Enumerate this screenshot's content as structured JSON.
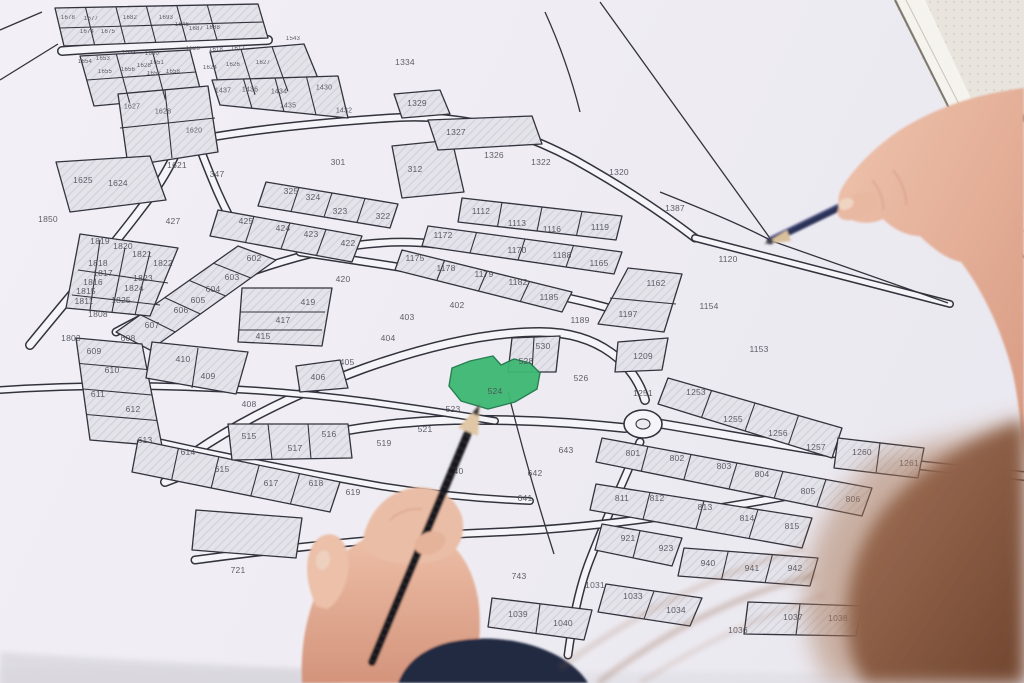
{
  "map": {
    "type": "cadastral parcel map",
    "highlighted_parcel": {
      "number": "524",
      "color": "#3eb873"
    },
    "colors": {
      "paper": "#efedf3",
      "line": "#33333d",
      "hatch_fill": "#e4e3ea",
      "road": "#f5f4f8",
      "blue_pencil": "#2b3156",
      "black_pencil": "#17171b",
      "skin": "#e2a98f",
      "hair": "#8d5a41"
    },
    "parcel_labels": [
      {
        "n": "1678",
        "x": 68,
        "y": 18
      },
      {
        "n": "1677",
        "x": 91,
        "y": 19
      },
      {
        "n": "1682",
        "x": 130,
        "y": 18
      },
      {
        "n": "1693",
        "x": 166,
        "y": 18
      },
      {
        "n": "1646",
        "x": 182,
        "y": 25
      },
      {
        "n": "1687",
        "x": 196,
        "y": 29
      },
      {
        "n": "1688",
        "x": 213,
        "y": 28
      },
      {
        "n": "1674",
        "x": 87,
        "y": 32
      },
      {
        "n": "1675",
        "x": 108,
        "y": 32
      },
      {
        "n": "1543",
        "x": 293,
        "y": 39
      },
      {
        "n": "1620",
        "x": 193,
        "y": 49
      },
      {
        "n": "1618",
        "x": 216,
        "y": 50
      },
      {
        "n": "1617",
        "x": 238,
        "y": 49
      },
      {
        "n": "1654",
        "x": 85,
        "y": 62
      },
      {
        "n": "1653",
        "x": 103,
        "y": 59
      },
      {
        "n": "1652",
        "x": 129,
        "y": 53
      },
      {
        "n": "1650",
        "x": 152,
        "y": 54
      },
      {
        "n": "1651",
        "x": 157,
        "y": 63
      },
      {
        "n": "1628",
        "x": 144,
        "y": 66
      },
      {
        "n": "1655",
        "x": 105,
        "y": 72
      },
      {
        "n": "1656",
        "x": 128,
        "y": 70
      },
      {
        "n": "1657",
        "x": 154,
        "y": 74
      },
      {
        "n": "1658",
        "x": 173,
        "y": 72
      },
      {
        "n": "1624",
        "x": 210,
        "y": 68
      },
      {
        "n": "1626",
        "x": 233,
        "y": 65
      },
      {
        "n": "1627",
        "x": 263,
        "y": 63
      },
      {
        "n": "1437",
        "x": 223,
        "y": 91
      },
      {
        "n": "1436",
        "x": 250,
        "y": 90
      },
      {
        "n": "1434",
        "x": 279,
        "y": 92
      },
      {
        "n": "1430",
        "x": 324,
        "y": 88
      },
      {
        "n": "1435",
        "x": 288,
        "y": 106
      },
      {
        "n": "1432",
        "x": 344,
        "y": 111
      },
      {
        "n": "1627",
        "x": 132,
        "y": 107
      },
      {
        "n": "1628",
        "x": 163,
        "y": 112
      },
      {
        "n": "1620",
        "x": 194,
        "y": 131
      },
      {
        "n": "1621",
        "x": 177,
        "y": 165
      },
      {
        "n": "1334",
        "x": 405,
        "y": 62
      },
      {
        "n": "1329",
        "x": 417,
        "y": 103
      },
      {
        "n": "1327",
        "x": 456,
        "y": 132
      },
      {
        "n": "1326",
        "x": 494,
        "y": 155
      },
      {
        "n": "1322",
        "x": 541,
        "y": 162
      },
      {
        "n": "1320",
        "x": 619,
        "y": 172
      },
      {
        "n": "1387",
        "x": 675,
        "y": 208
      },
      {
        "n": "301",
        "x": 338,
        "y": 162
      },
      {
        "n": "312",
        "x": 415,
        "y": 169
      },
      {
        "n": "347",
        "x": 217,
        "y": 174
      },
      {
        "n": "325",
        "x": 291,
        "y": 191
      },
      {
        "n": "324",
        "x": 313,
        "y": 197
      },
      {
        "n": "323",
        "x": 340,
        "y": 211
      },
      {
        "n": "322",
        "x": 383,
        "y": 216
      },
      {
        "n": "427",
        "x": 173,
        "y": 221
      },
      {
        "n": "425",
        "x": 246,
        "y": 221
      },
      {
        "n": "424",
        "x": 283,
        "y": 228
      },
      {
        "n": "423",
        "x": 311,
        "y": 234
      },
      {
        "n": "422",
        "x": 348,
        "y": 243
      },
      {
        "n": "420",
        "x": 343,
        "y": 279
      },
      {
        "n": "1625",
        "x": 83,
        "y": 180
      },
      {
        "n": "1624",
        "x": 118,
        "y": 183
      },
      {
        "n": "1850",
        "x": 48,
        "y": 219
      },
      {
        "n": "1819",
        "x": 100,
        "y": 241
      },
      {
        "n": "1820",
        "x": 123,
        "y": 246
      },
      {
        "n": "1821",
        "x": 142,
        "y": 254
      },
      {
        "n": "1822",
        "x": 163,
        "y": 263
      },
      {
        "n": "1818",
        "x": 98,
        "y": 263
      },
      {
        "n": "1817",
        "x": 103,
        "y": 273
      },
      {
        "n": "1823",
        "x": 143,
        "y": 278
      },
      {
        "n": "1824",
        "x": 134,
        "y": 288
      },
      {
        "n": "1825",
        "x": 121,
        "y": 300
      },
      {
        "n": "1816",
        "x": 93,
        "y": 282
      },
      {
        "n": "1815",
        "x": 86,
        "y": 291
      },
      {
        "n": "1811",
        "x": 84,
        "y": 301
      },
      {
        "n": "1808",
        "x": 98,
        "y": 314
      },
      {
        "n": "1803",
        "x": 71,
        "y": 338
      },
      {
        "n": "602",
        "x": 254,
        "y": 258
      },
      {
        "n": "603",
        "x": 232,
        "y": 277
      },
      {
        "n": "604",
        "x": 213,
        "y": 289
      },
      {
        "n": "605",
        "x": 198,
        "y": 300
      },
      {
        "n": "606",
        "x": 181,
        "y": 310
      },
      {
        "n": "607",
        "x": 152,
        "y": 325
      },
      {
        "n": "608",
        "x": 128,
        "y": 338
      },
      {
        "n": "609",
        "x": 94,
        "y": 351
      },
      {
        "n": "610",
        "x": 112,
        "y": 370
      },
      {
        "n": "611",
        "x": 98,
        "y": 394
      },
      {
        "n": "612",
        "x": 133,
        "y": 409
      },
      {
        "n": "613",
        "x": 145,
        "y": 440
      },
      {
        "n": "614",
        "x": 188,
        "y": 452
      },
      {
        "n": "615",
        "x": 222,
        "y": 469
      },
      {
        "n": "617",
        "x": 271,
        "y": 483
      },
      {
        "n": "618",
        "x": 316,
        "y": 483
      },
      {
        "n": "619",
        "x": 353,
        "y": 492
      },
      {
        "n": "419",
        "x": 308,
        "y": 302
      },
      {
        "n": "417",
        "x": 283,
        "y": 320
      },
      {
        "n": "415",
        "x": 263,
        "y": 336
      },
      {
        "n": "410",
        "x": 183,
        "y": 359
      },
      {
        "n": "409",
        "x": 208,
        "y": 376
      },
      {
        "n": "408",
        "x": 249,
        "y": 404
      },
      {
        "n": "406",
        "x": 318,
        "y": 377
      },
      {
        "n": "402",
        "x": 457,
        "y": 305
      },
      {
        "n": "403",
        "x": 407,
        "y": 317
      },
      {
        "n": "404",
        "x": 388,
        "y": 338
      },
      {
        "n": "405",
        "x": 347,
        "y": 362
      },
      {
        "n": "1112",
        "x": 481,
        "y": 211
      },
      {
        "n": "1113",
        "x": 517,
        "y": 223
      },
      {
        "n": "1116",
        "x": 552,
        "y": 229
      },
      {
        "n": "1119",
        "x": 600,
        "y": 227
      },
      {
        "n": "1172",
        "x": 443,
        "y": 235
      },
      {
        "n": "1170",
        "x": 517,
        "y": 250
      },
      {
        "n": "1188",
        "x": 562,
        "y": 255
      },
      {
        "n": "1165",
        "x": 599,
        "y": 263
      },
      {
        "n": "1175",
        "x": 415,
        "y": 258
      },
      {
        "n": "1178",
        "x": 446,
        "y": 268
      },
      {
        "n": "1179",
        "x": 484,
        "y": 274
      },
      {
        "n": "1182",
        "x": 518,
        "y": 282
      },
      {
        "n": "1185",
        "x": 549,
        "y": 297
      },
      {
        "n": "1162",
        "x": 656,
        "y": 283
      },
      {
        "n": "1197",
        "x": 628,
        "y": 314
      },
      {
        "n": "1189",
        "x": 580,
        "y": 320
      },
      {
        "n": "1120",
        "x": 728,
        "y": 259
      },
      {
        "n": "1154",
        "x": 709,
        "y": 306
      },
      {
        "n": "1153",
        "x": 759,
        "y": 349
      },
      {
        "n": "530",
        "x": 543,
        "y": 346
      },
      {
        "n": "528",
        "x": 526,
        "y": 361
      },
      {
        "n": "526",
        "x": 581,
        "y": 378
      },
      {
        "n": "524",
        "x": 495,
        "y": 391
      },
      {
        "n": "523",
        "x": 453,
        "y": 409
      },
      {
        "n": "521",
        "x": 425,
        "y": 429
      },
      {
        "n": "519",
        "x": 384,
        "y": 443
      },
      {
        "n": "515",
        "x": 249,
        "y": 436
      },
      {
        "n": "516",
        "x": 329,
        "y": 434
      },
      {
        "n": "517",
        "x": 295,
        "y": 448
      },
      {
        "n": "640",
        "x": 456,
        "y": 471
      },
      {
        "n": "642",
        "x": 535,
        "y": 473
      },
      {
        "n": "641",
        "x": 525,
        "y": 498
      },
      {
        "n": "643",
        "x": 566,
        "y": 450
      },
      {
        "n": "721",
        "x": 238,
        "y": 570
      },
      {
        "n": "740",
        "x": 379,
        "y": 570
      },
      {
        "n": "741",
        "x": 423,
        "y": 576
      },
      {
        "n": "743",
        "x": 519,
        "y": 576
      },
      {
        "n": "801",
        "x": 633,
        "y": 453
      },
      {
        "n": "802",
        "x": 677,
        "y": 458
      },
      {
        "n": "803",
        "x": 724,
        "y": 466
      },
      {
        "n": "804",
        "x": 762,
        "y": 474
      },
      {
        "n": "805",
        "x": 808,
        "y": 491
      },
      {
        "n": "806",
        "x": 853,
        "y": 499
      },
      {
        "n": "811",
        "x": 622,
        "y": 498
      },
      {
        "n": "812",
        "x": 657,
        "y": 498
      },
      {
        "n": "813",
        "x": 705,
        "y": 507
      },
      {
        "n": "814",
        "x": 747,
        "y": 518
      },
      {
        "n": "815",
        "x": 792,
        "y": 526
      },
      {
        "n": "921",
        "x": 628,
        "y": 538
      },
      {
        "n": "923",
        "x": 666,
        "y": 548
      },
      {
        "n": "940",
        "x": 708,
        "y": 563
      },
      {
        "n": "941",
        "x": 752,
        "y": 568
      },
      {
        "n": "942",
        "x": 795,
        "y": 568
      },
      {
        "n": "1031",
        "x": 595,
        "y": 585
      },
      {
        "n": "1033",
        "x": 633,
        "y": 596
      },
      {
        "n": "1034",
        "x": 676,
        "y": 610
      },
      {
        "n": "1036",
        "x": 738,
        "y": 630
      },
      {
        "n": "1037",
        "x": 793,
        "y": 617
      },
      {
        "n": "1038",
        "x": 838,
        "y": 618
      },
      {
        "n": "1039",
        "x": 518,
        "y": 614
      },
      {
        "n": "1040",
        "x": 563,
        "y": 623
      },
      {
        "n": "1209",
        "x": 643,
        "y": 356
      },
      {
        "n": "1251",
        "x": 643,
        "y": 393
      },
      {
        "n": "1253",
        "x": 696,
        "y": 392
      },
      {
        "n": "1255",
        "x": 733,
        "y": 419
      },
      {
        "n": "1256",
        "x": 778,
        "y": 433
      },
      {
        "n": "1257",
        "x": 816,
        "y": 447
      },
      {
        "n": "1260",
        "x": 862,
        "y": 452
      },
      {
        "n": "1261",
        "x": 909,
        "y": 463
      }
    ]
  }
}
